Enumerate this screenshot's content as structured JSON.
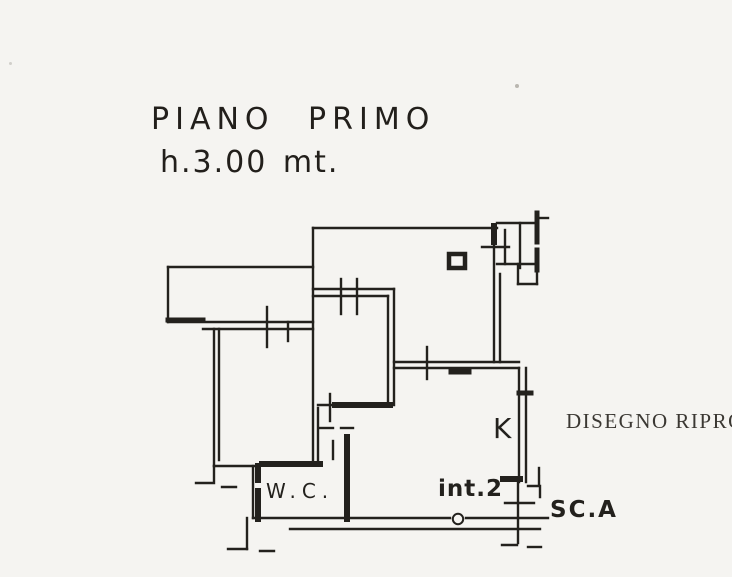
{
  "title": {
    "line1": "PIANO PRIMO",
    "line2": "h.3.00 mt."
  },
  "plan_labels": {
    "wc": "W.C.",
    "kitchen": "K",
    "unit": "int.2",
    "staircase": "SC.A"
  },
  "stamp": {
    "text": "DISEGNO RIPRO"
  },
  "colors": {
    "ink": "#23211d",
    "paper": "#f5f4f1",
    "stamp_ink": "#3b3833"
  }
}
